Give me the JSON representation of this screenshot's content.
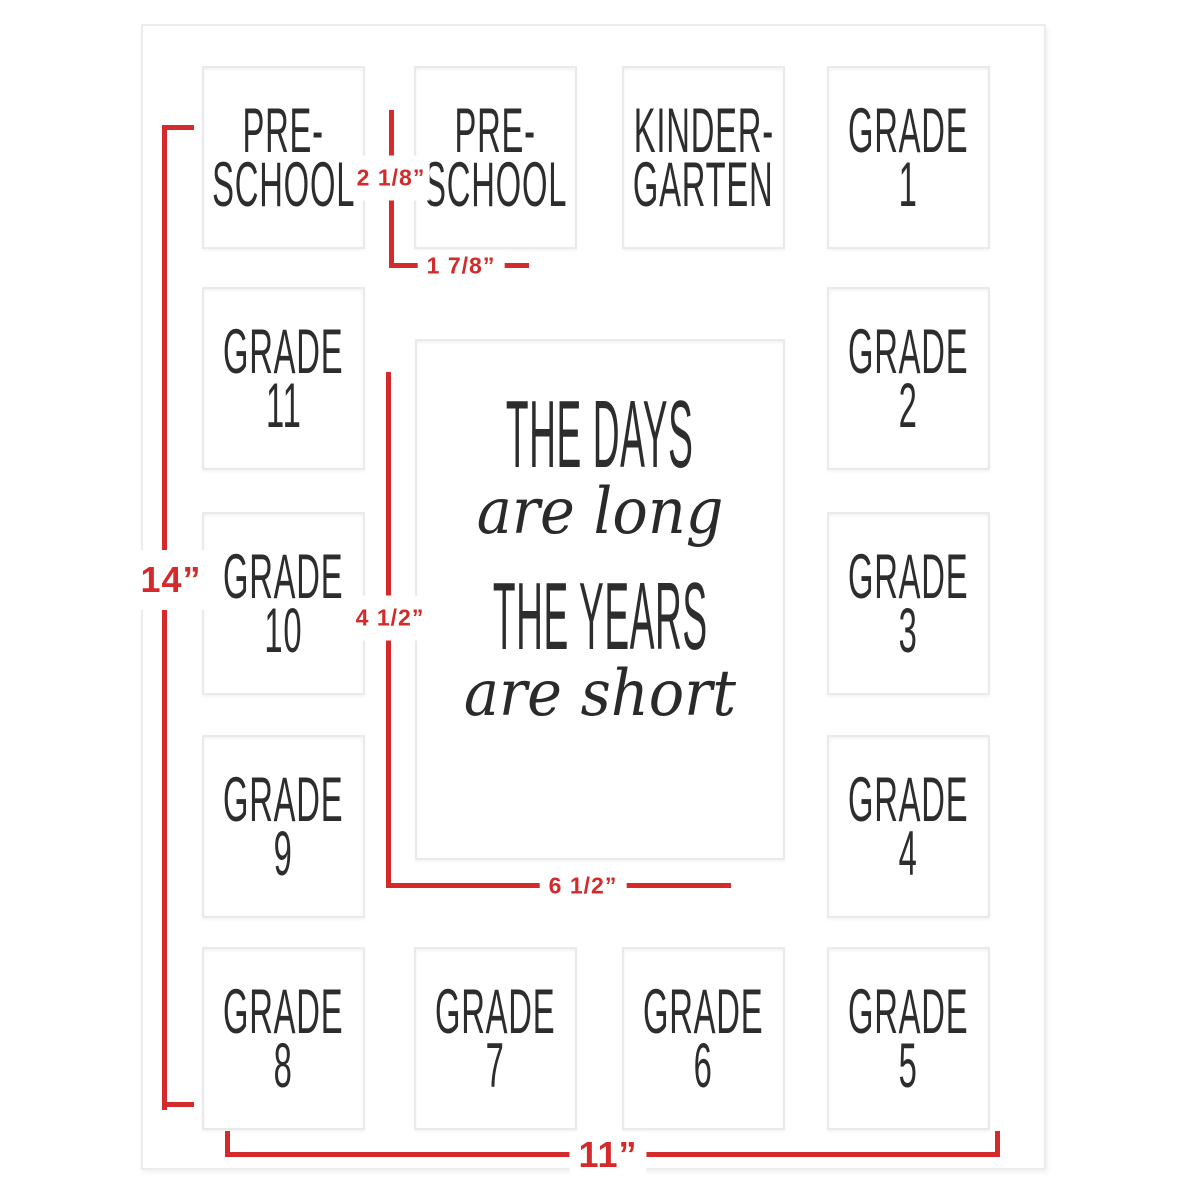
{
  "openings": [
    {
      "name": "preschool-1",
      "line1": "PRE-",
      "line2": "SCHOOL"
    },
    {
      "name": "preschool-2",
      "line1": "PRE-",
      "line2": "SCHOOL"
    },
    {
      "name": "kindergarten",
      "line1": "KINDER-",
      "line2": "GARTEN"
    },
    {
      "name": "grade-1",
      "line1": "GRADE",
      "line2": "1"
    },
    {
      "name": "grade-11",
      "line1": "GRADE",
      "line2": "11"
    },
    {
      "name": "grade-2",
      "line1": "GRADE",
      "line2": "2"
    },
    {
      "name": "grade-10",
      "line1": "GRADE",
      "line2": "10"
    },
    {
      "name": "grade-3",
      "line1": "GRADE",
      "line2": "3"
    },
    {
      "name": "grade-9",
      "line1": "GRADE",
      "line2": "9"
    },
    {
      "name": "grade-4",
      "line1": "GRADE",
      "line2": "4"
    },
    {
      "name": "grade-8",
      "line1": "GRADE",
      "line2": "8"
    },
    {
      "name": "grade-7",
      "line1": "GRADE",
      "line2": "7"
    },
    {
      "name": "grade-6",
      "line1": "GRADE",
      "line2": "6"
    },
    {
      "name": "grade-5",
      "line1": "GRADE",
      "line2": "5"
    }
  ],
  "quote": {
    "caps1": "THE DAYS",
    "script1": "are long",
    "caps2": "THE YEARS",
    "script2": "are short"
  },
  "dimensions": {
    "mat_height": "14”",
    "mat_width": "11”",
    "small_opening_height": "2 1/8”",
    "small_opening_width": "1 7/8”",
    "center_opening_width": "4 1/2”",
    "center_opening_height": "6 1/2”"
  },
  "colors": {
    "dimension_red": "#d32b2b",
    "label_text": "#2d2d2d",
    "mat_border_gray": "#ececec"
  }
}
